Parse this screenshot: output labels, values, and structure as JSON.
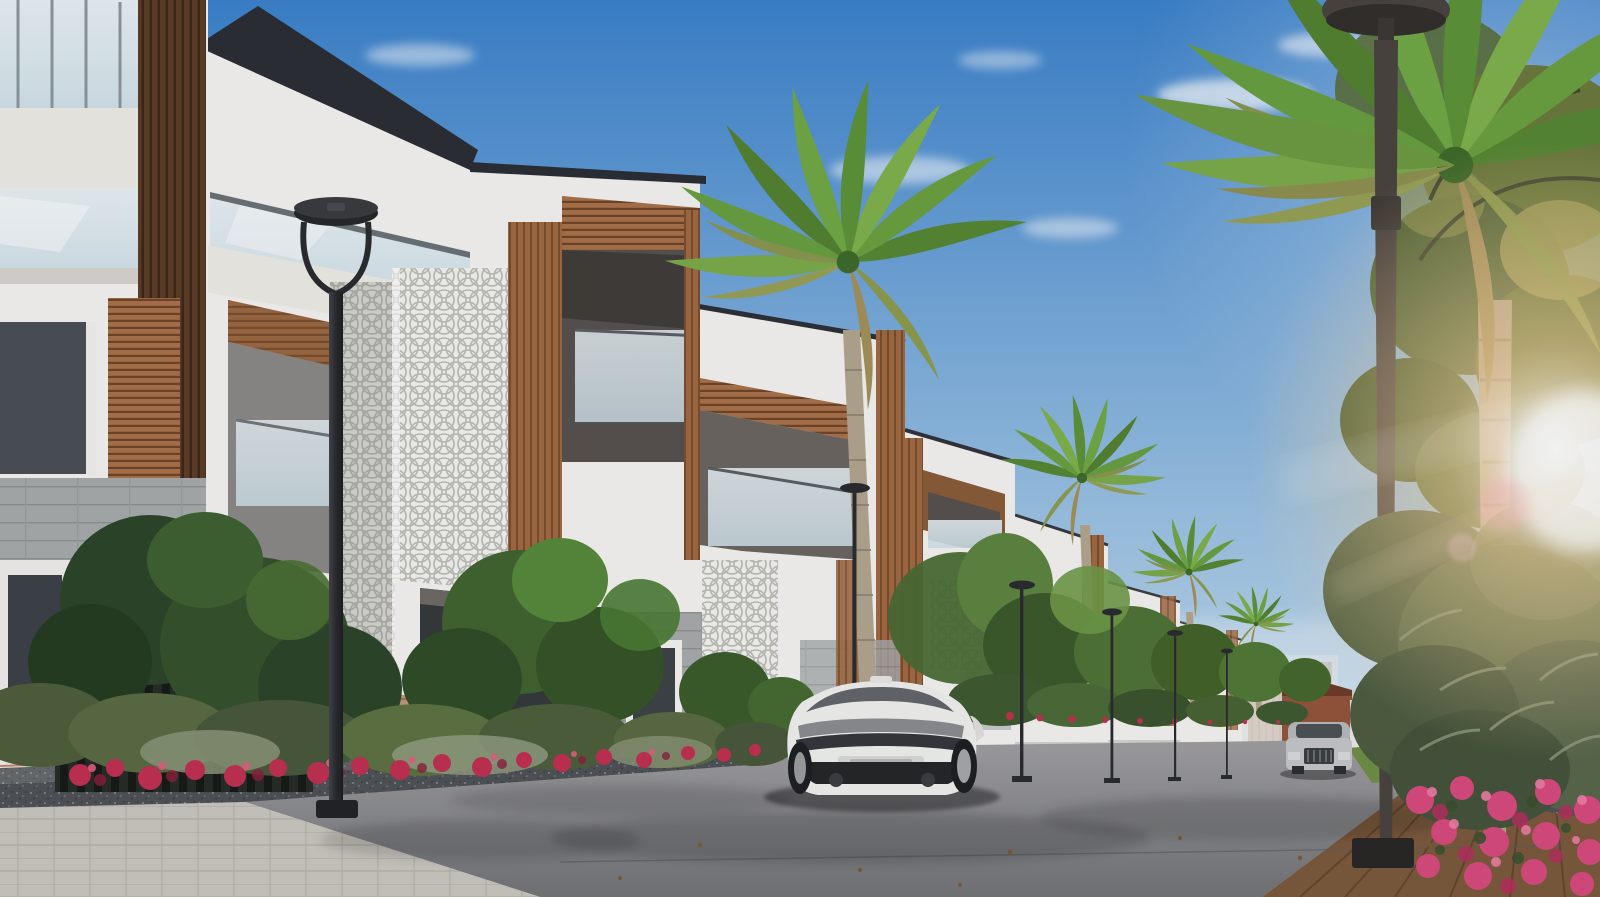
{
  "scene": {
    "type": "architectural-render-photo",
    "description": "Sunny 3D render of a modern villa community street: white villas with wood-slat and white lattice facades on the left, palm trees and street lamps lining an asphalt road, a white sports coupe driving away in the center, a distant silver SUV approaching, flower beds with crimson and pink blooms, and sun flare through a large palm on the right",
    "time_of_day": "day",
    "objects": [
      {
        "name": "villa-row-left",
        "label": "Row of modern white villas with wood slats, glass balustrades and ornamental white lattice pillars"
      },
      {
        "name": "white-sports-coupe",
        "label": "White sports coupe seen from behind, center of road"
      },
      {
        "name": "silver-suv",
        "label": "Silver SUV approaching in the distance"
      },
      {
        "name": "street-lamp-foreground-left",
        "label": "Dark circular-head street lamp, left foreground"
      },
      {
        "name": "street-lamp-right",
        "label": "Tall street lamp with saucer head, right foreground"
      },
      {
        "name": "receding-street-lamps",
        "label": "Row of small street lamps receding on the right"
      },
      {
        "name": "palm-trees",
        "label": "Royal palms along the street and one large palm on the right"
      },
      {
        "name": "hedges-and-flowers",
        "label": "Green hedges with crimson flower beds along granite planters"
      },
      {
        "name": "pink-flower-bed-right",
        "label": "Pink flower bed in right foreground"
      },
      {
        "name": "brick-house-distant",
        "label": "Distant red brick house with chimneys at street end"
      },
      {
        "name": "wood-deck-walkway",
        "label": "Wooden deck walkway, bottom right"
      },
      {
        "name": "paver-sidewalk",
        "label": "Light paver sidewalk, bottom left"
      },
      {
        "name": "dark-slat-fence",
        "label": "Dark vertical slat fence behind shrubs, lower left"
      },
      {
        "name": "sun-flare",
        "label": "Warm sun flare glowing through palm fronds, right side"
      }
    ]
  },
  "palette": {
    "sky_top": "#3b82cc",
    "sky_mid": "#9fc5e4",
    "sky_horizon": "#dce9f0",
    "cloud": "#ffffff",
    "facade_white": "#f5f4f1",
    "facade_warm": "#efece6",
    "facade_shadow": "#d9d6d0",
    "roof_dark": "#2b2e33",
    "wood_accent": "#a06a42",
    "wood_dark": "#5c3d26",
    "stone_gray": "#a7abab",
    "glass_blue": "#cfe0e8",
    "lattice_white": "#f4f4f1",
    "interior_shadow": "#35393a",
    "foliage_dark": "#2c4527",
    "foliage_mid": "#4a6b33",
    "foliage_light": "#7fa24a",
    "olive_shrub": "#6d7a58",
    "palm_green": "#5d8f3c",
    "palm_trunk": "#b3a68f",
    "flower_red": "#c03052",
    "flower_pink": "#d84a7e",
    "asphalt_light": "#a0a0a2",
    "asphalt_dark": "#737477",
    "paver_light": "#cbc8c0",
    "granite_dark": "#4f5356",
    "granite_light": "#8e9296",
    "deck_brown": "#7c5a3c",
    "lamp_black": "#2b2c2e",
    "lamp_pole_right": "#4a4440",
    "car_white": "#f1f1ef",
    "car_silver": "#b9babc",
    "grass_green": "#6d8f46",
    "sun_glow": "#ffd9a0"
  }
}
